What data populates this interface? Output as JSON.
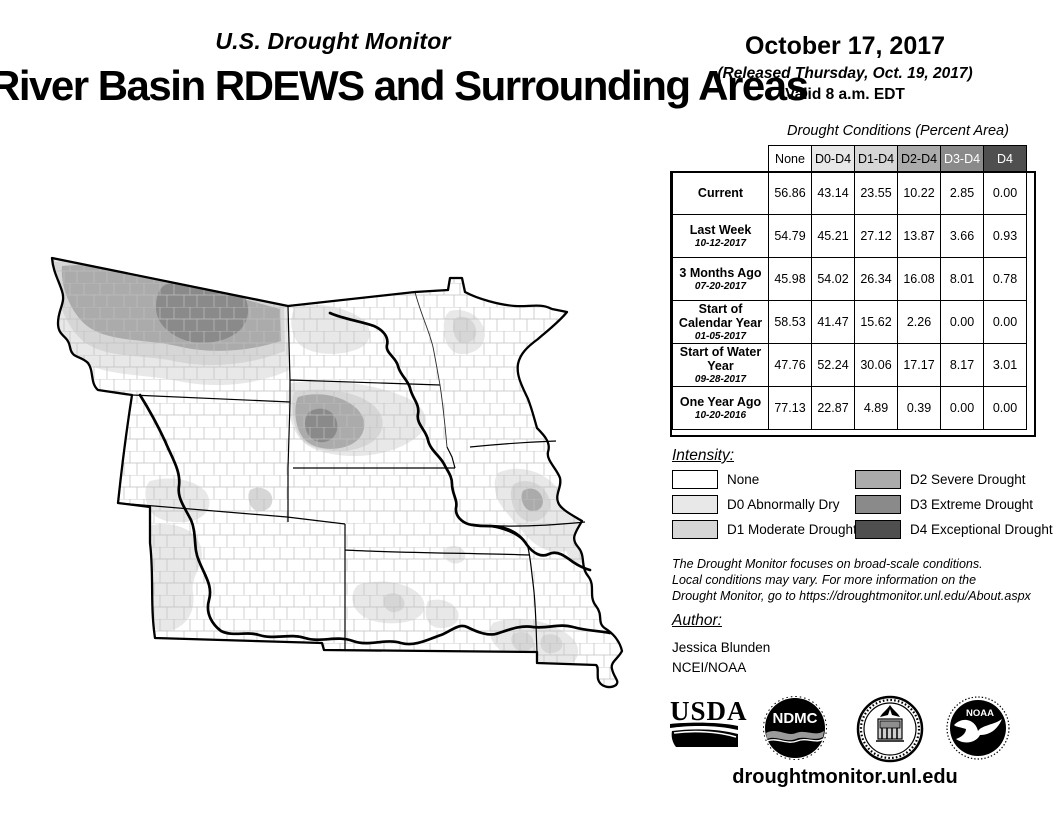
{
  "header": {
    "monitor_label": "U.S. Drought Monitor",
    "title": "River Basin RDEWS and Surrounding Areas",
    "date": "October 17, 2017",
    "released": "(Released Thursday, Oct. 19, 2017)",
    "valid": "Valid 8 a.m. EDT"
  },
  "table": {
    "title": "Drought Conditions (Percent Area)",
    "columns": [
      "None",
      "D0-D4",
      "D1-D4",
      "D2-D4",
      "D3-D4",
      "D4"
    ],
    "header_colors": [
      "#ffffff",
      "#e8e8e8",
      "#d6d6d6",
      "#ababab",
      "#8a8a8a",
      "#4f4f4f"
    ],
    "rows": [
      {
        "label": "Current",
        "date": "",
        "values": [
          "56.86",
          "43.14",
          "23.55",
          "10.22",
          "2.85",
          "0.00"
        ]
      },
      {
        "label": "Last Week",
        "date": "10-12-2017",
        "values": [
          "54.79",
          "45.21",
          "27.12",
          "13.87",
          "3.66",
          "0.93"
        ]
      },
      {
        "label": "3 Months Ago",
        "date": "07-20-2017",
        "values": [
          "45.98",
          "54.02",
          "26.34",
          "16.08",
          "8.01",
          "0.78"
        ]
      },
      {
        "label": "Start of Calendar Year",
        "date": "01-05-2017",
        "values": [
          "58.53",
          "41.47",
          "15.62",
          "2.26",
          "0.00",
          "0.00"
        ]
      },
      {
        "label": "Start of Water Year",
        "date": "09-28-2017",
        "values": [
          "47.76",
          "52.24",
          "30.06",
          "17.17",
          "8.17",
          "3.01"
        ]
      },
      {
        "label": "One Year Ago",
        "date": "10-20-2016",
        "values": [
          "77.13",
          "22.87",
          "4.89",
          "0.39",
          "0.00",
          "0.00"
        ]
      }
    ]
  },
  "legend": {
    "title": "Intensity:",
    "items": [
      {
        "label": "None",
        "color": "#ffffff"
      },
      {
        "label": "D0 Abnormally Dry",
        "color": "#e8e8e8"
      },
      {
        "label": "D1 Moderate Drought",
        "color": "#d6d6d6"
      },
      {
        "label": "D2 Severe Drought",
        "color": "#ababab"
      },
      {
        "label": "D3 Extreme Drought",
        "color": "#8a8a8a"
      },
      {
        "label": "D4 Exceptional Drought",
        "color": "#4f4f4f"
      }
    ]
  },
  "disclaimer": {
    "lines": [
      "The Drought Monitor focuses on broad-scale conditions.",
      "Local conditions may vary. For more information on the",
      "Drought Monitor, go to https://droughtmonitor.unl.edu/About.aspx"
    ]
  },
  "author": {
    "title": "Author:",
    "name": "Jessica Blunden",
    "org": "NCEI/NOAA"
  },
  "footer": {
    "url": "droughtmonitor.unl.edu",
    "logos": {
      "usda": "USDA",
      "ndmc": "NDMC",
      "doc": "U.S. Department of Commerce",
      "noaa": "NOAA"
    }
  }
}
